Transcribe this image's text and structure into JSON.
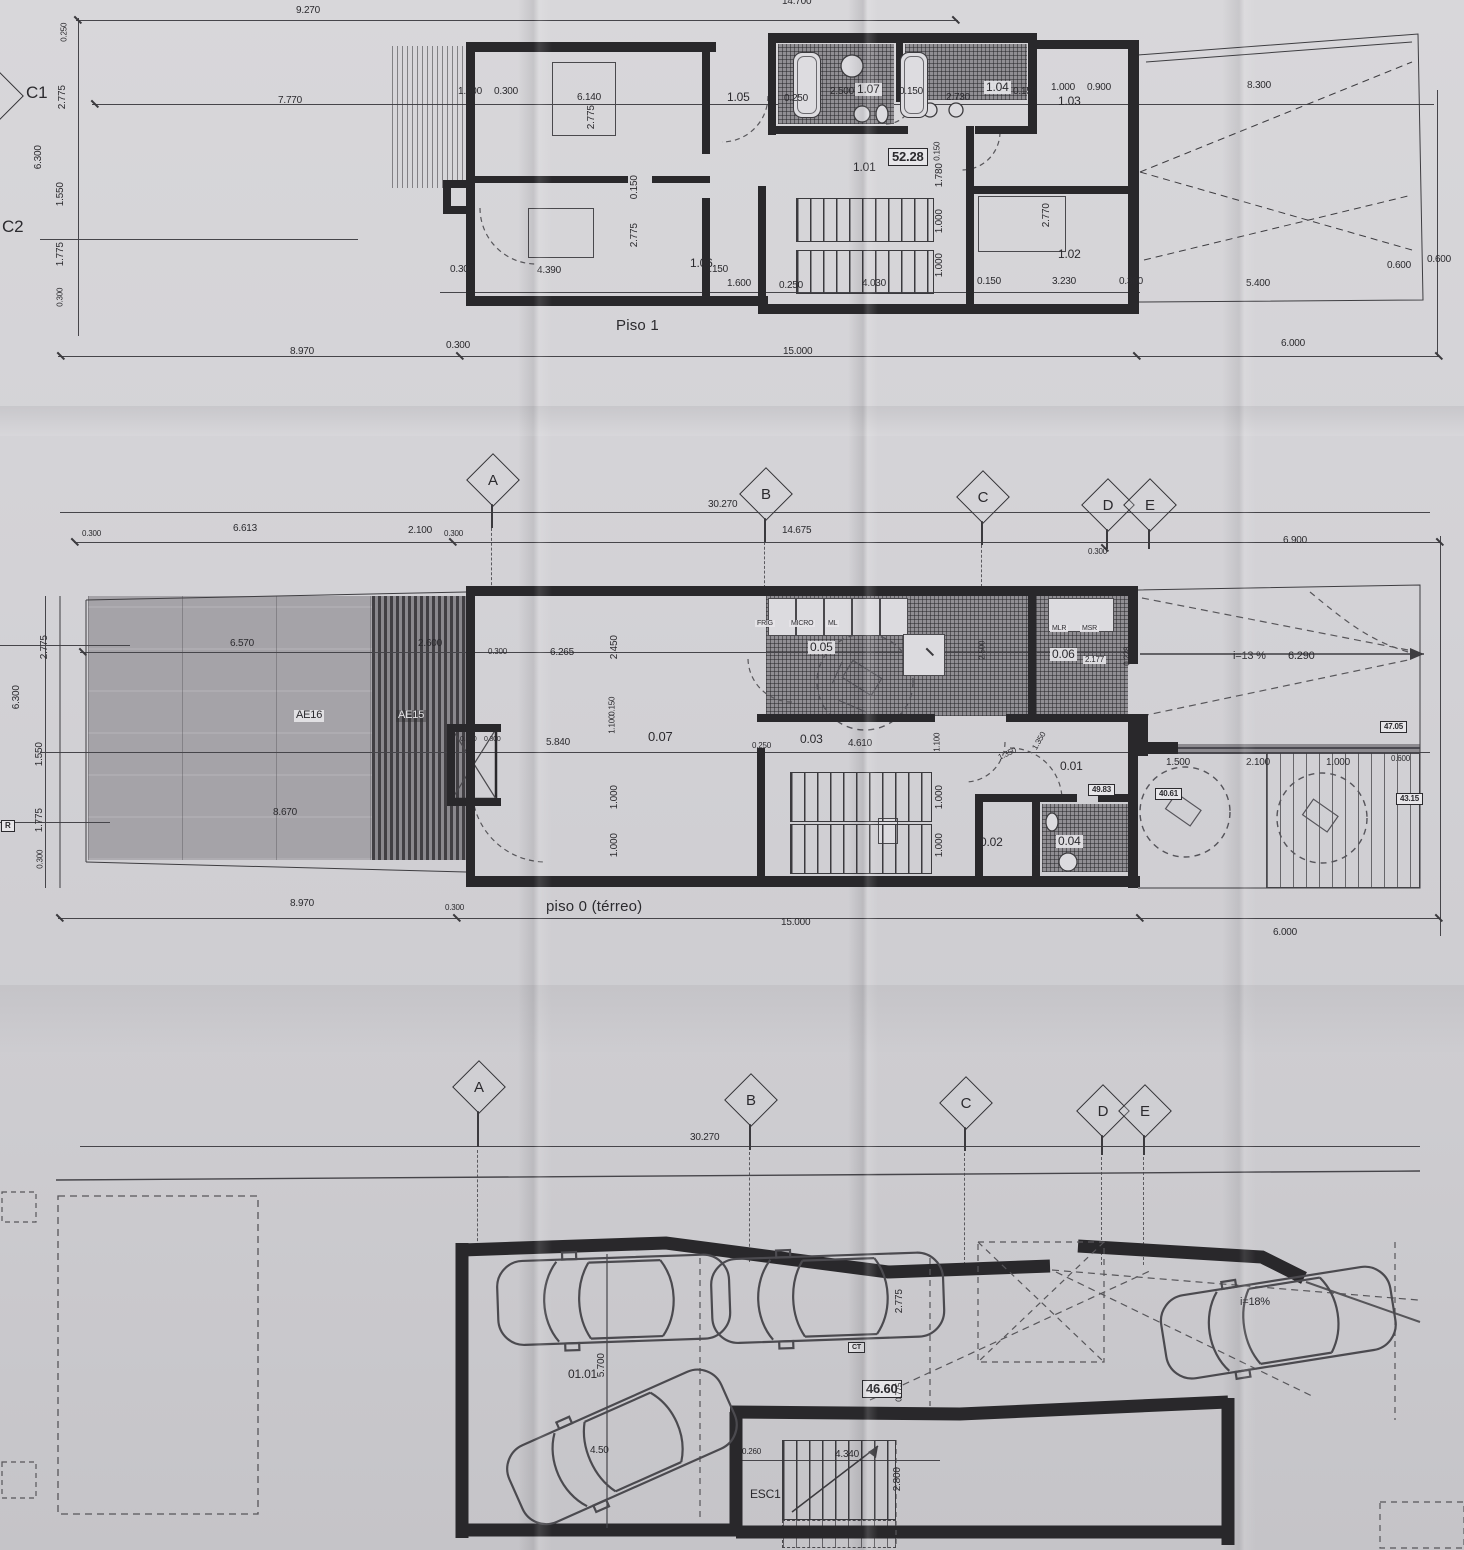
{
  "grid": {
    "a": "A",
    "b": "B",
    "c": "C",
    "d": "D",
    "e": "E"
  },
  "p1": {
    "title": "Piso 1",
    "row_c1": "C1",
    "row_c2": "C2",
    "rooms": {
      "r101": "1.01",
      "r102": "1.02",
      "r103": "1.03",
      "r104": "1.04",
      "r105": "1.05",
      "r106": "1.06",
      "r107": "1.07"
    },
    "area_box": "52.28",
    "dims": {
      "t9270": "9.270",
      "t14700": "14.700",
      "l7770": "7.770",
      "a1500": "1.500",
      "a0300": "0.300",
      "a6140": "6.140",
      "a0250": "0.250",
      "a2500": "2.500",
      "a0150": "0.150",
      "a2730": "2.730",
      "b0150": "0.150",
      "a1000": "1.000",
      "a0900": "0.900",
      "r8300": "8.300",
      "v2775a": "2.775",
      "v0150a": "0.150",
      "v2775b": "2.775",
      "c0300": "0.300",
      "c4390": "4.390",
      "c0150": "0.150",
      "c1600": "1.600",
      "c0250": "0.250",
      "c4030": "4.030",
      "d0150": "0.150",
      "d3230": "3.230",
      "d0300": "0.300",
      "r5400": "5.400",
      "r0600a": "0.600",
      "r0600b": "0.600",
      "s0150": "0.150",
      "s1780": "1.780",
      "s1000a": "1.000",
      "s1000b": "1.000",
      "v2770": "2.770",
      "b0300": "0.300",
      "b8970": "8.970",
      "b15000": "15.000",
      "b6000": "6.000",
      "lc0250": "0.250",
      "lc2775": "2.775",
      "lc6300": "6.300",
      "lc1550": "1.550",
      "lc1775": "1.775",
      "lc0300": "0.300"
    }
  },
  "p0": {
    "title": "piso 0 (térreo)",
    "row_r": "R",
    "rooms": {
      "r001": "0.01",
      "r002": "0.02",
      "r003": "0.03",
      "r004": "0.04",
      "r005": "0.05",
      "r006": "0.06",
      "r007": "0.07"
    },
    "zones": {
      "ae16": "AE16",
      "ae15": "AE15"
    },
    "areas": {
      "a4983": "49.83",
      "a4705": "47.05",
      "a4315": "43.15",
      "a4061": "40.61"
    },
    "appl": {
      "frig": "FRIG",
      "micro": "MICRO",
      "ml": "ML",
      "mlr": "MLR",
      "msr": "MSR",
      "lvs": "LVS"
    },
    "ramp": {
      "slope": "i=13 %",
      "len": "6.290"
    },
    "dims": {
      "g30270": "30.270",
      "g14675": "14.675",
      "ga0300": "0.300",
      "gb0300": "0.300",
      "g6900": "6.900",
      "gl0300": "0.300",
      "g6613": "6.613",
      "g2100": "2.100",
      "p6570": "6.570",
      "p2600": "2.600",
      "p0300": "0.300",
      "p8670": "8.670",
      "k6265": "6.265",
      "k2450": "2.450",
      "k2500": "2.500",
      "k2177": "2.177",
      "k0228": "0.228",
      "c0150": "0.150",
      "c1100": "1.100",
      "c5840": "5.840",
      "c0510": "0.510",
      "c0300": "0.300",
      "c1000a": "1.000",
      "c1000b": "1.000",
      "h0250": "0.250",
      "h4610": "4.610",
      "h1100": "1.100",
      "h1000a": "1.000",
      "h1000b": "1.000",
      "h1350a": "1.350",
      "h1350b": "1.350",
      "r1500": "1.500",
      "r2100": "2.100",
      "r1000": "1.000",
      "r0600": "0.600",
      "b8970": "8.970",
      "b0300": "0.300",
      "b15000": "15.000",
      "b6000": "6.000",
      "lc2775": "2.775",
      "lc6300": "6.300",
      "lc1550": "1.550",
      "lc1775": "1.775",
      "lc0300": "0.300"
    }
  },
  "g": {
    "room": "01.01",
    "esc": "ESC1",
    "ct": "CT",
    "area_box": "46.60",
    "ramp_slope": "i=18%",
    "dims": {
      "g30270": "30.270",
      "v5700": "5.700",
      "d450": "4.50",
      "d0260": "0.260",
      "d4340": "4.340",
      "v2800": "2.800",
      "v2775": "2.775",
      "v0775": "0.775"
    }
  }
}
